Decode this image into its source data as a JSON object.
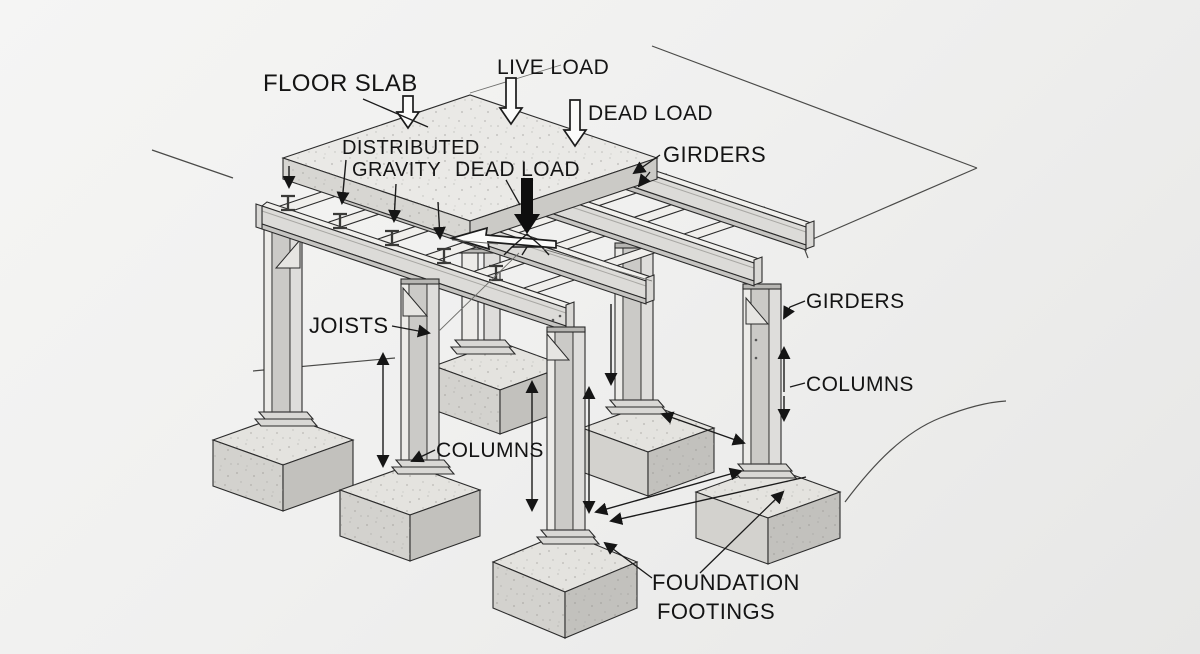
{
  "diagram": {
    "subject": "structural steel frame load path diagram",
    "labels": [
      {
        "id": "floor-slab",
        "text": "FLOOR SLAB"
      },
      {
        "id": "live-load",
        "text": "LIVE LOAD"
      },
      {
        "id": "dead-load-top",
        "text": "DEAD LOAD"
      },
      {
        "id": "distributed",
        "text": "DISTRIBUTED"
      },
      {
        "id": "gravity",
        "text": "GRAVITY"
      },
      {
        "id": "dead-load-center",
        "text": "DEAD LOAD"
      },
      {
        "id": "girders-top",
        "text": "GIRDERS"
      },
      {
        "id": "girders-right",
        "text": "GIRDERS"
      },
      {
        "id": "columns-right",
        "text": "COLUMNS"
      },
      {
        "id": "joists",
        "text": "JOISTS"
      },
      {
        "id": "columns-center",
        "text": "COLUMNS"
      },
      {
        "id": "foundation",
        "text": "FOUNDATION"
      },
      {
        "id": "footings",
        "text": "FOOTINGS"
      }
    ]
  },
  "colors": {
    "background": "#f1f1f0",
    "line": "#2b2b2b",
    "text": "#141414",
    "steel_face": "#dcdbd8",
    "steel_light": "#f0efec",
    "steel_dark": "#c6c5c2",
    "slab_top": "#eae9e6",
    "slab_side": "#d7d6d2",
    "concrete_top": "#e4e3df",
    "concrete_left": "#d3d2ce",
    "concrete_right": "#c2c1bd",
    "arrow": "#151515"
  },
  "icons": [
    {
      "name": "hollow-down-arrow",
      "meaning": "applied load direction"
    },
    {
      "name": "filled-down-arrow",
      "meaning": "distributed gravity load"
    },
    {
      "name": "dimension-arrow",
      "meaning": "span / height extent"
    },
    {
      "name": "point-load-arrow",
      "meaning": "concentrated dead load"
    }
  ]
}
